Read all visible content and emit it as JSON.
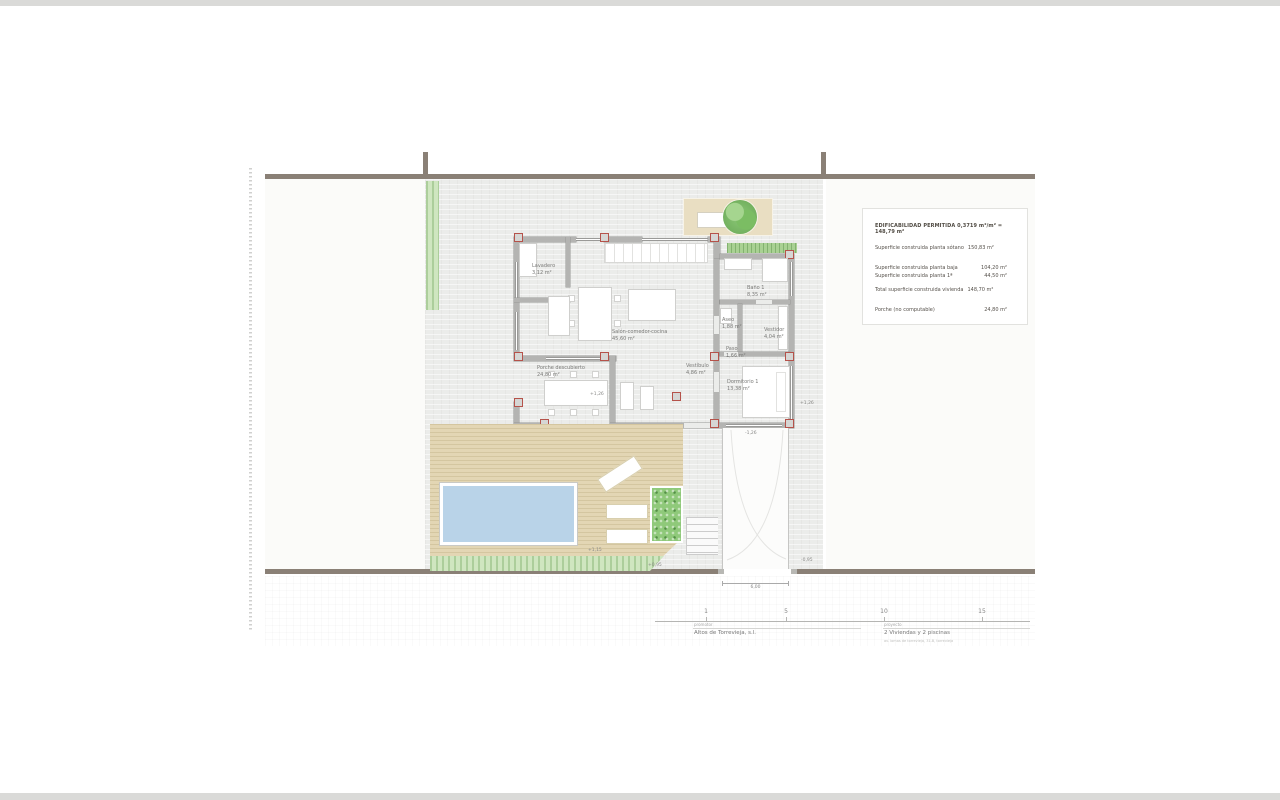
{
  "legend": {
    "header": "EDIFICABILIDAD PERMITIDA 0,3719 m²/m² = 148,79 m²",
    "rows": [
      {
        "label": "Superficie construida planta sótano",
        "value": "150,83 m²"
      },
      {
        "label": "Superficie construida planta baja",
        "value": "104,20 m²"
      },
      {
        "label": "Superficie construida planta 1ª",
        "value": "44,50 m²"
      },
      {
        "label": "Total superficie construida vivienda",
        "value": "148,70 m²"
      },
      {
        "label": "Porche (no computable)",
        "value": "24,80 m²"
      }
    ]
  },
  "rooms": [
    {
      "name": "Lavadero",
      "area": "3,12 m²"
    },
    {
      "name": "Salón-comedor-cocina",
      "area": "45,60 m²"
    },
    {
      "name": "Baño 1",
      "area": "8,35 m²"
    },
    {
      "name": "Aseo",
      "area": "1,88 m²"
    },
    {
      "name": "Vestidor",
      "area": "4,04 m²"
    },
    {
      "name": "Paso",
      "area": "1,66 m²"
    },
    {
      "name": "Vestíbulo",
      "area": "4,86 m²"
    },
    {
      "name": "Dormitorio 1",
      "area": "13,38 m²"
    },
    {
      "name": "Porche descubierto",
      "area": "24,80 m²"
    }
  ],
  "levels": {
    "porch": "+1,26",
    "east": "+1,26",
    "ramp_top": "-1,26",
    "deck": "+1,15",
    "steps": "+0,95",
    "ramp_bottom": "-0,95"
  },
  "dimension": {
    "gate_width": "6,00"
  },
  "scalebar": {
    "ticks": [
      "1",
      "5",
      "10",
      "15"
    ]
  },
  "footer": {
    "promoter_label": "promotor",
    "promoter": "Altos de Torrevieja, s.l.",
    "project_label": "proyecto",
    "project": "2 Viviendas y 2 piscinas",
    "address": "av. lomas de torrevieja, 31-B, torrevieja"
  },
  "colors": {
    "boundary_wall": "#8a8076",
    "house_wall": "#b4b4b2",
    "column_red": "#b5524a",
    "paving": "#ebecea",
    "deck": "#e3d6b4",
    "pool_water": "#b9d3e8",
    "lawn": "#cfe6c0",
    "hedge": "#a9d193",
    "legend_text": "#55504a",
    "room_text": "#7a7a78"
  }
}
